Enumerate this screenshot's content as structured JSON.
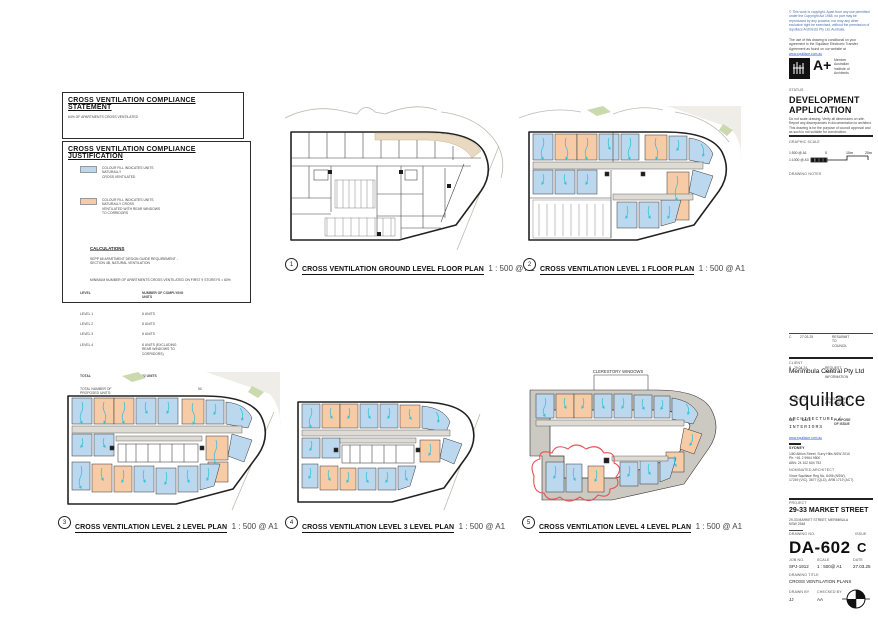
{
  "sheet": {
    "compliance_statement": {
      "title": "CROSS VENTILATION COMPLIANCE STATEMENT",
      "body": "64% OF APARTMENTS CROSS VENTILATED"
    },
    "justification": {
      "title": "CROSS VENTILATION COMPLIANCE JUSTIFICATION",
      "legend": [
        {
          "color": "#BCD8EE",
          "label": "COLOUR FILL INDICATES UNITS NATURALLY\nCROSS VENTILATED"
        },
        {
          "color": "#F7CBA6",
          "label": "COLOUR FILL INDICATES UNITS NATURALLY CROSS\nVENTILATED WITH REAR WINDOWS TO CORRIDORS"
        }
      ],
      "calculations": {
        "heading": "CALCULATIONS",
        "line1": "SEPP 65 APARTMENT DESIGN GUIDE REQUIREMENT -\nSECTION 4B, NATURAL VENTILATION",
        "line2": "MINIMUM NUMBER OF APARTMENTS CROSS VENTILATED ON FIRST 9 STOREYS = 60%",
        "table_header": {
          "col1": "LEVEL",
          "col2": "NUMBER OF COMPLYING UNITS"
        },
        "rows": [
          {
            "level": "LEVEL 1",
            "units": "8 UNITS"
          },
          {
            "level": "LEVEL 2",
            "units": "8 UNITS"
          },
          {
            "level": "LEVEL 3",
            "units": "8 UNITS"
          },
          {
            "level": "LEVEL 4",
            "units": "8 UNITS (EXCLUDING REAR WINDOWS TO CORRIDORS)"
          },
          {
            "level": "TOTAL",
            "units": "32 UNITS"
          }
        ],
        "summary": [
          {
            "label": "TOTAL NUMBER OF PROPOSED UNITS:",
            "value": "50"
          },
          {
            "label": "PERCENTAGE OF COMPLYING UNITS:",
            "value": "64.0%"
          },
          {
            "label": "PERCENTAGE OF COMPLYING UNITS\n(INCLUDING REAR WINDOWS TO CORRIDORS):",
            "value": "96.0%"
          }
        ]
      }
    },
    "plans": [
      {
        "num": "1",
        "title": "CROSS VENTILATION GROUND LEVEL FLOOR PLAN",
        "scale": "1 : 500 @ A1"
      },
      {
        "num": "2",
        "title": "CROSS VENTILATION LEVEL 1 FLOOR PLAN",
        "scale": "1 : 500 @ A1"
      },
      {
        "num": "3",
        "title": "CROSS VENTILATION LEVEL 2 LEVEL PLAN",
        "scale": "1 : 500 @ A1"
      },
      {
        "num": "4",
        "title": "CROSS VENTILATION LEVEL 3 LEVEL PLAN",
        "scale": "1 : 500 @ A1"
      },
      {
        "num": "5",
        "title": "CROSS VENTILATION LEVEL 4 LEVEL PLAN",
        "scale": "1 : 500 @ A1"
      }
    ],
    "annotations": {
      "clerestory": "CLERESTORY WINDOWS"
    }
  },
  "titleblock": {
    "copyright1": "© This work is copyright. Apart from any use permitted under the Copyright Act 1968, no part may be reproduced by any process, nor may any other exclusive right be exercised, without the permission of Squillace Architects Pty Ltd, Australia.",
    "copyright2": "The use of this drawing is conditional on your agreement to the Squillace Electronic Transfer Agreement as found on our website at",
    "copyright_link": "www.squillace.com.au",
    "aplus": {
      "label": "A+",
      "member": "Member\nAustralian\nInstitute of\nArchitects"
    },
    "status_label": "STATUS",
    "status": "DEVELOPMENT APPLICATION",
    "disclaimer": "Do not scale drawing. Verify all dimensions on site. Report any discrepancies in documentation to architect. This drawing is for the purpose of council approval and as such is not suitable for construction.",
    "graphic_scale": {
      "label": "GRAPHIC SCALE",
      "row1": "1:500 @ A1",
      "row2": "1:1000 @ A3",
      "tick0": "0",
      "tick10": "10m",
      "tick20": "20m"
    },
    "drawing_notes_label": "DRAWING NOTES",
    "revisions": {
      "header": {
        "iss": "ISS",
        "date": "DATE",
        "purpose": "PURPOSE OF ISSUE"
      },
      "rows": [
        {
          "iss": "C",
          "date": "27.03.25",
          "purpose": "RESUBMIT TO COUNCIL"
        },
        {
          "iss": "B",
          "date": "29.04.24",
          "purpose": "REQUEST FOR INFORMATION"
        },
        {
          "iss": "A",
          "date": "04.02.22",
          "purpose": "DEVELOPMENT APPLICATION"
        }
      ]
    },
    "client_label": "CLIENT",
    "client": "Merimbula Central Pty Ltd",
    "logo": "squillace",
    "logo_sub1": "ARCHITECTURE /",
    "logo_sub2": "INTERIORS",
    "website": "www.squillace.com.au",
    "office_label": "SYDNEY",
    "office_lines": "1/80 Albion Street, Surry Hills NSW 2010\nPh: +61 2 9964 9500\nABN: 24 102 604 753",
    "architect_label": "NOMINATED ARCHITECT",
    "architect": "Vince Squillace Reg No. 6496 (NSW),\n17249 (VIC), 3677 (QLD), ARB 1719 (ACT)",
    "project_label": "PROJECT",
    "project": "29-33 MARKET STREET",
    "project_address": "29-33 MARKET STREET, MERIMBULA\nNSW 2548",
    "drawing_no_label": "DRAWING NO.",
    "drawing_no": "DA-602",
    "issue_label": "ISSUE",
    "issue": "C",
    "job_no_label": "JOB NO.",
    "job_no": "SPJ-1912",
    "scale_label": "SCALE",
    "scale": "1 : 500@ A1",
    "date_label": "DATE",
    "date": "27.03.25",
    "drawing_title_label": "DRAWING TITLE",
    "drawing_title": "CROSS VENTILATION PLANS",
    "drawn_by_label": "DRAWN BY",
    "drawn_by": "JJ",
    "checked_by_label": "CHECKED BY",
    "checked_by": "AA"
  }
}
